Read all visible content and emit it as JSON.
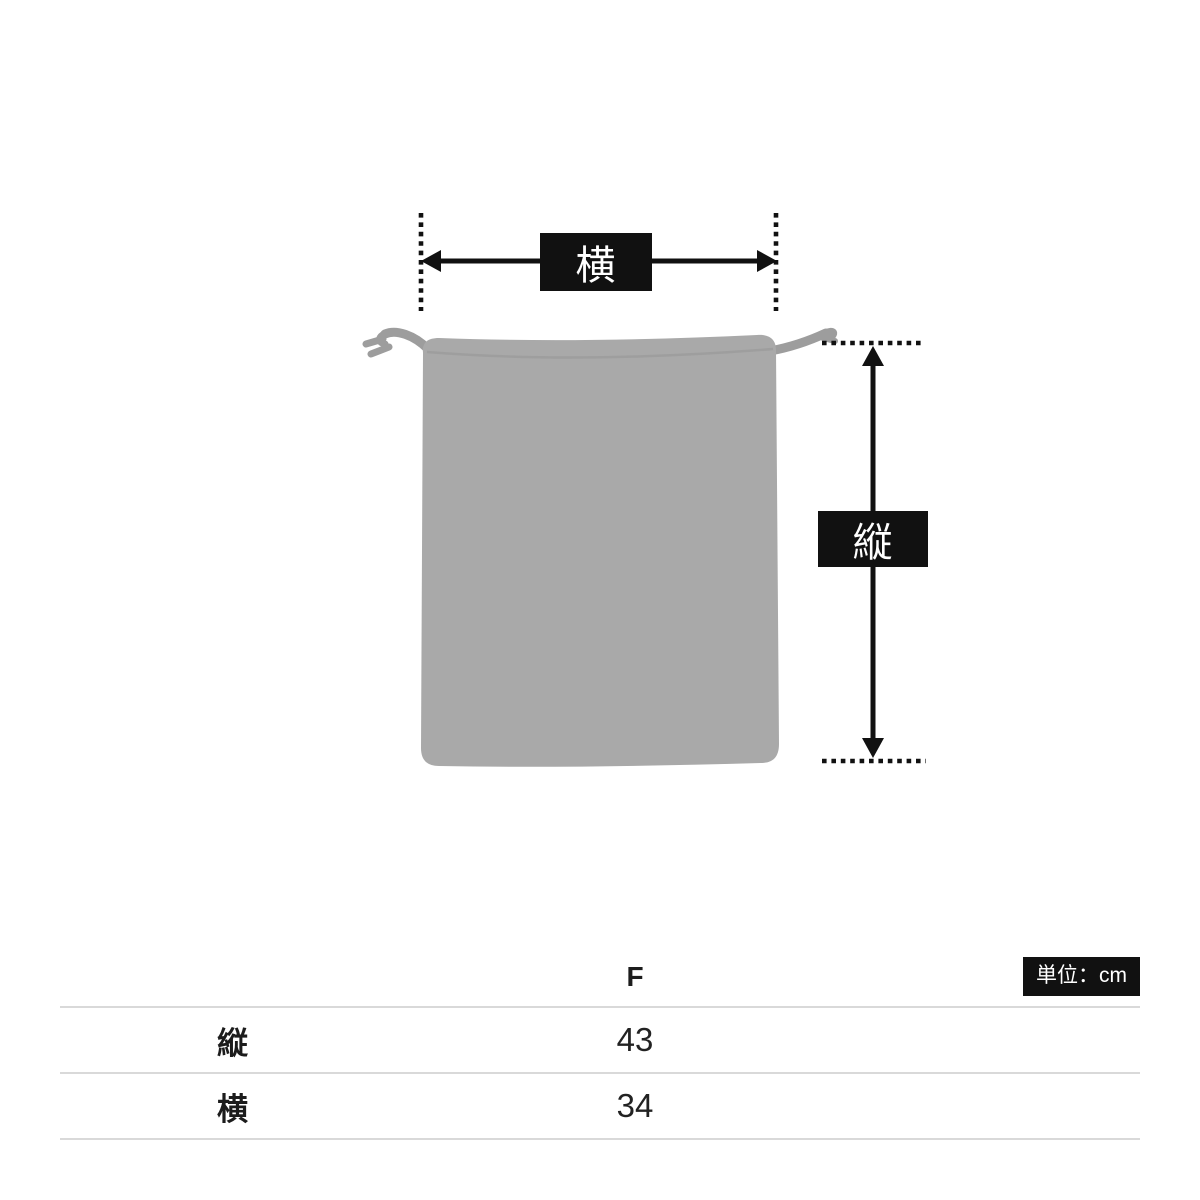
{
  "theme": {
    "accent": "#111111",
    "bag_color": "#a9a9a9",
    "bag_shade": "#9b9b9b",
    "cord_color": "#9d9d9d",
    "table_line": "#d9d9d9",
    "text": "#1c1c1c",
    "page_bg": "#ffffff"
  },
  "diagram": {
    "width_label": "横",
    "height_label": "縦"
  },
  "size_table": {
    "unit_badge": "単位：cm",
    "size_header": "F",
    "rows": [
      {
        "label": "縦",
        "value": "43"
      },
      {
        "label": "横",
        "value": "34"
      }
    ]
  }
}
